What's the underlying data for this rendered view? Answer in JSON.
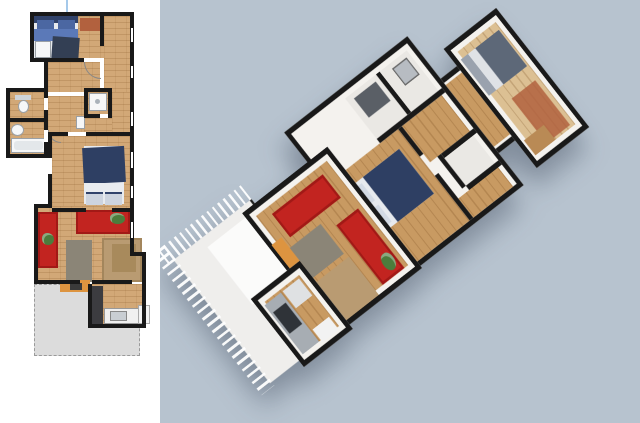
{
  "panels": {
    "plan_2d": {
      "name": "2d-floor-plan-view"
    },
    "view_3d": {
      "name": "3d-aerial-view"
    }
  },
  "rooms": [
    {
      "id": "bedroom-top"
    },
    {
      "id": "corridor"
    },
    {
      "id": "wc"
    },
    {
      "id": "bathroom"
    },
    {
      "id": "shower-room"
    },
    {
      "id": "bedroom-middle"
    },
    {
      "id": "living-room"
    },
    {
      "id": "kitchen"
    },
    {
      "id": "terrace"
    }
  ],
  "furniture": [
    {
      "id": "double-bed-top"
    },
    {
      "id": "rug"
    },
    {
      "id": "toilet"
    },
    {
      "id": "sink"
    },
    {
      "id": "bathtub"
    },
    {
      "id": "shower"
    },
    {
      "id": "double-bed-middle"
    },
    {
      "id": "red-sofa-vertical"
    },
    {
      "id": "red-sofa-horizontal"
    },
    {
      "id": "plant"
    },
    {
      "id": "coffee-table"
    },
    {
      "id": "dining-rug"
    },
    {
      "id": "desk"
    },
    {
      "id": "kitchen-counter"
    },
    {
      "id": "kitchen-sink"
    },
    {
      "id": "fridge"
    },
    {
      "id": "tall-cabinet"
    },
    {
      "id": "stove"
    },
    {
      "id": "terrace-railing"
    }
  ],
  "colors": {
    "bg_left": "#ffffff",
    "bg_3d": "#b7c3cf",
    "wall": "#191919",
    "wood": "#d2a877",
    "wood_3d": "#c89a62",
    "wood_light_3d": "#dcc093",
    "white_wall_3d": "#f4f2ee",
    "room_light_3d": "#eae8e4",
    "sofa_red": "#c22420",
    "bed_navy": "#2e3f63",
    "pillow_blue": "#4b67a2",
    "blanket_blue": "#5b79b8",
    "linen_white": "#e7eaee",
    "bed_gray_3d": "#5d6878",
    "bed_gray_base_3d": "#9aa2ae",
    "rug_brown": "#b2613e",
    "table_tan": "#b99b72",
    "table_tan_dark": "#a88a5c",
    "table_gray": "#8b8577",
    "desk_orange": "#dd9440",
    "terrace_gray": "#dcdcdc",
    "terrace_border": "#9a9a9a",
    "terrace_3d": "#efeeec",
    "counter_gray": "#a7adb3",
    "appliance_white": "#f2f2f2",
    "fixture_white": "#f6f7f8",
    "fixture_border": "#9aa0a6",
    "cabinet_dark": "#3c3c40",
    "stove_dark": "#2f3338",
    "plant_green": "#4c7c3c",
    "camera_line": "#a5c9ea"
  }
}
